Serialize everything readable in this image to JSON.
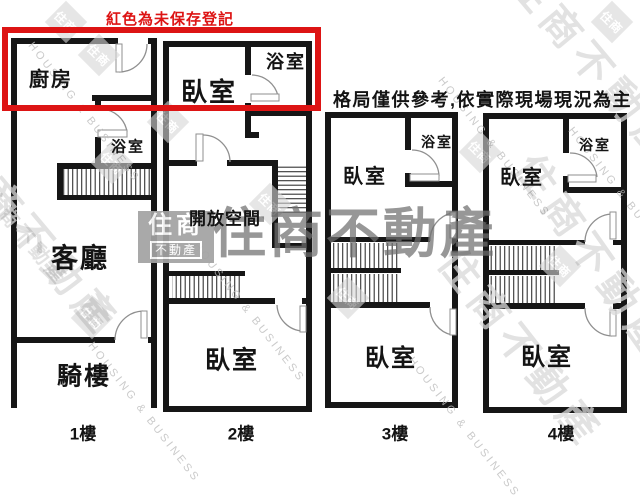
{
  "annotations": {
    "unsaved_legend": "紅色為未保存登記",
    "disclaimer": "格局僅供參考,依實際現場現況為主"
  },
  "watermark": {
    "brand": "住商不動產",
    "brand_en": "HOUSING & BUSINESS",
    "logo_top": "住商",
    "logo_bottom": "不動產",
    "diamond": "住商"
  },
  "floors": [
    {
      "label": "1樓",
      "rooms": {
        "kitchen": "廚房",
        "bathroom": "浴室",
        "living_room": "客廳",
        "arcade": "騎樓"
      }
    },
    {
      "label": "2樓",
      "rooms": {
        "bedroom_top": "臥室",
        "bathroom": "浴室",
        "open_space": "開放空間",
        "bedroom_bottom": "臥室"
      }
    },
    {
      "label": "3樓",
      "rooms": {
        "bedroom_top": "臥室",
        "bathroom": "浴室",
        "bedroom_bottom": "臥室"
      }
    },
    {
      "label": "4樓",
      "rooms": {
        "bedroom_top": "臥室",
        "bathroom": "浴室",
        "bedroom_bottom": "臥室"
      }
    }
  ],
  "colors": {
    "unsaved_red": "#dd1414",
    "wall_black": "#161616",
    "watermark_gray": "#a3a3a3"
  }
}
